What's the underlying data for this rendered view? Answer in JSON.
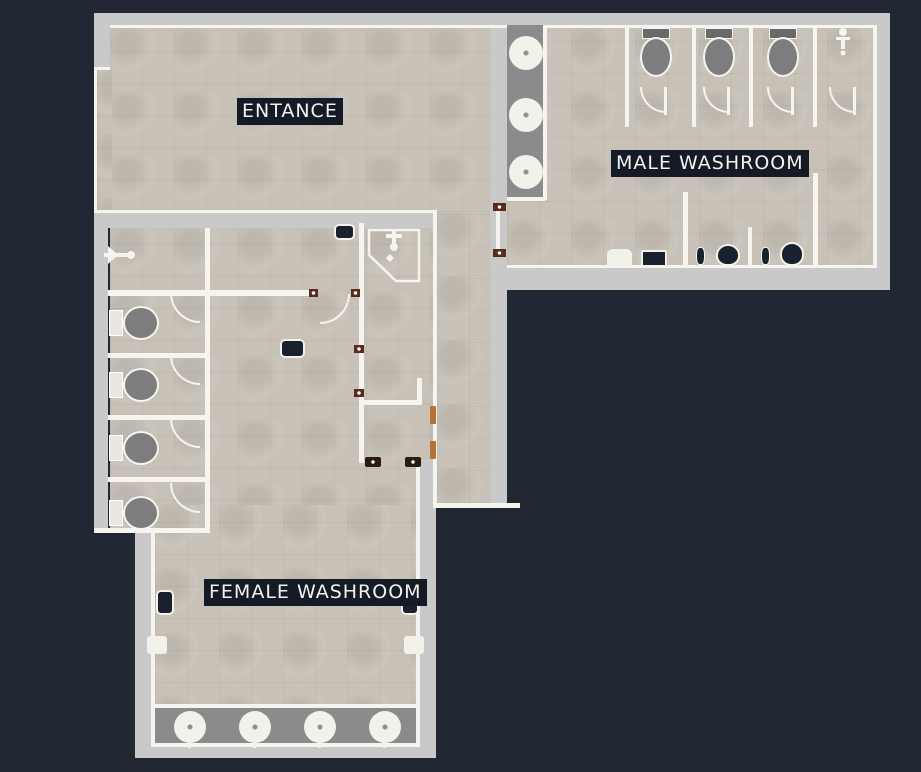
{
  "labels": {
    "entrance": "ENTANCE",
    "male_washroom": "MALE WASHROOM",
    "female_washroom": "FEMALE WASHROOM"
  },
  "colors": {
    "background": "#212834",
    "floor": "#c7c1b7",
    "wall_outer": "#c9c9c9",
    "wall_line": "#f5f4ef",
    "counter": "#8b8b8b",
    "fixture_gray": "#7d7d7d",
    "tank_dark": "#696969",
    "fixture_dark": "#1a212e",
    "porcelain": "#f2f1ea",
    "label_bg": "#141a26",
    "label_text": "#f3f2ec",
    "door_jamb": "#5a2a1c",
    "door_jamb_dark": "#2a1a12",
    "door_frame": "#b4713a"
  },
  "rooms": {
    "entrance": {
      "label": "ENTANCE"
    },
    "male_washroom": {
      "label": "MALE WASHROOM",
      "fixtures": {
        "toilet_stalls": 3,
        "utility_stall": 1,
        "round_sinks": 3,
        "urinals": 2,
        "flush_valves": 2,
        "waste_bin": 1,
        "supply_box": 1
      }
    },
    "female_washroom": {
      "label": "FEMALE WASHROOM",
      "fixtures": {
        "toilet_stalls": 4,
        "corner_shower": 1,
        "round_sinks": 4,
        "waste_bins": 2,
        "hand_dryers": 2,
        "bench": 1,
        "wall_grab_bar": 1
      }
    },
    "corridor": {
      "fixtures": {
        "door_frames": 2,
        "entry_door": 1
      }
    }
  }
}
